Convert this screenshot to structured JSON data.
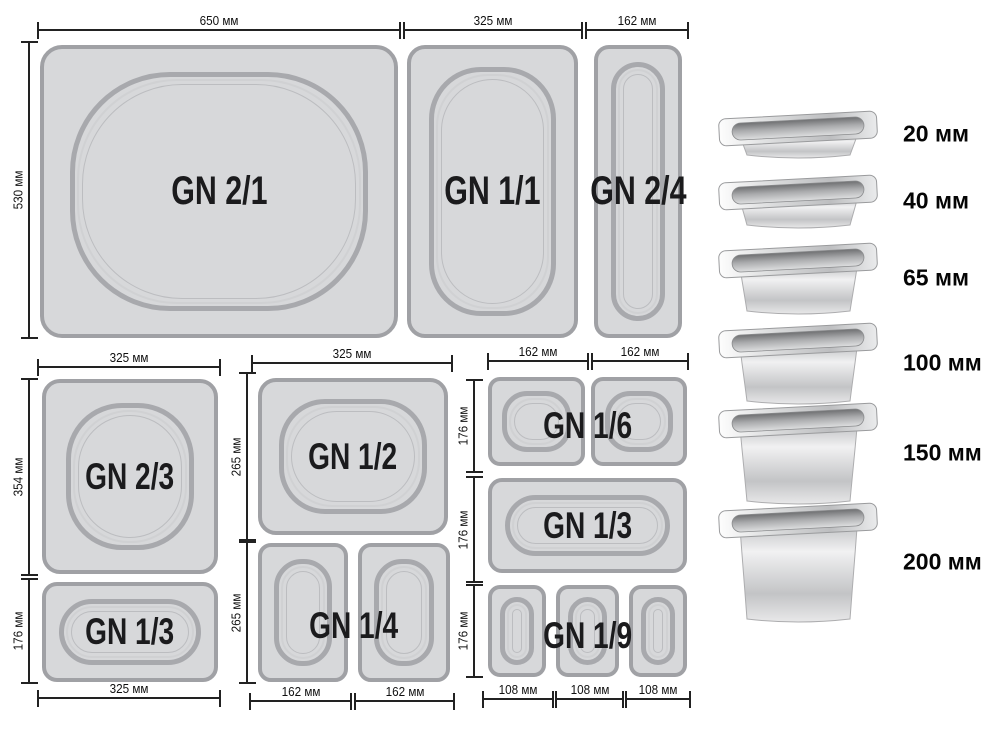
{
  "diagram": {
    "top_row": {
      "width_labels": [
        "650 мм",
        "325 мм",
        "162 мм"
      ],
      "height_label": "530 мм",
      "pans": [
        {
          "label": "GN 2/1"
        },
        {
          "label": "GN 1/1"
        },
        {
          "label": "GN 2/4"
        }
      ]
    },
    "left_col": {
      "top_width": "325 мм",
      "bottom_width": "325 мм",
      "height_labels": [
        "354 мм",
        "176 мм"
      ],
      "pans": [
        {
          "label": "GN 2/3"
        },
        {
          "label": "GN 1/3"
        }
      ]
    },
    "mid_col": {
      "top_width": "325 мм",
      "bottom_widths": [
        "162 мм",
        "162 мм"
      ],
      "height_labels": [
        "265 мм",
        "265 мм"
      ],
      "pans": [
        {
          "label": "GN 1/2"
        },
        {
          "label": "GN 1/4"
        }
      ]
    },
    "right_col": {
      "top_widths": [
        "162 мм",
        "162 мм"
      ],
      "bottom_widths": [
        "108 мм",
        "108 мм",
        "108 мм"
      ],
      "height_labels": [
        "176 мм",
        "176 мм",
        "176 мм"
      ],
      "pans": [
        {
          "label": "GN 1/6"
        },
        {
          "label": "GN 1/3"
        },
        {
          "label": "GN 1/9"
        }
      ]
    },
    "depths": [
      {
        "label": "20 мм"
      },
      {
        "label": "40 мм"
      },
      {
        "label": "65 мм"
      },
      {
        "label": "100 мм"
      },
      {
        "label": "150 мм"
      },
      {
        "label": "200 мм"
      }
    ],
    "colors": {
      "pan_fill": "#d7d8da",
      "pan_border": "#a0a1a5",
      "inner_ring": "#a8a9ad",
      "dim_line": "#222222",
      "label_text": "#1b1b1d",
      "background": "#ffffff"
    }
  }
}
